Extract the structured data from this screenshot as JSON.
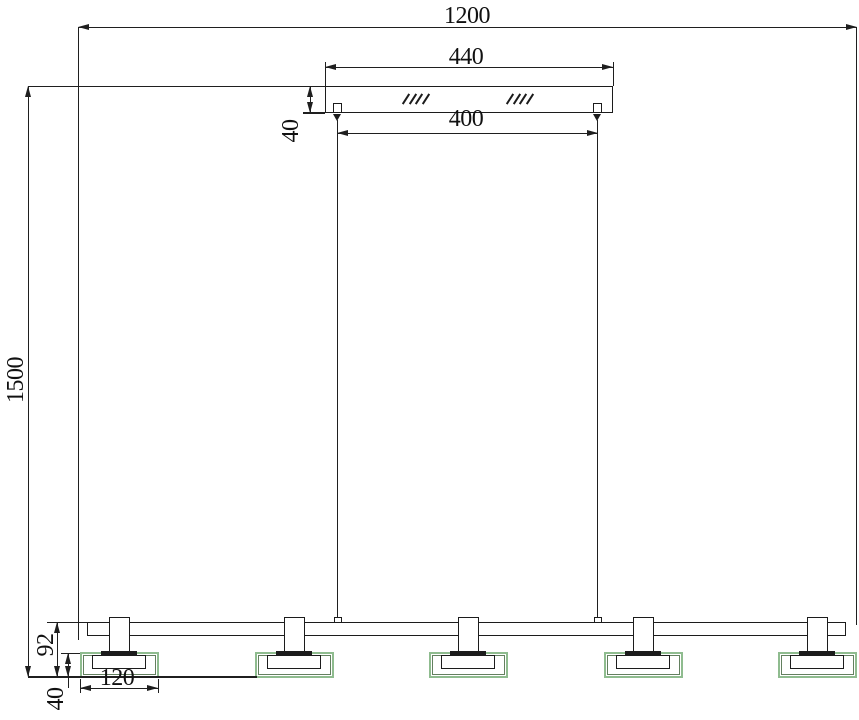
{
  "drawing": {
    "type": "technical-dimension-drawing",
    "subject": "linear pendant light fixture, 5 lamp heads",
    "lamp_head_count": 5,
    "dimensions": {
      "overall_width": "1200",
      "canopy_width": "440",
      "wire_spacing": "400",
      "canopy_height": "40",
      "overall_height": "1500",
      "head_height": "92",
      "shade_height": "40",
      "shade_width": "120"
    },
    "colors": {
      "line": "#1c1c1c",
      "shade_green": "#8fbc8f",
      "shade_green_dark": "#63805f"
    }
  }
}
